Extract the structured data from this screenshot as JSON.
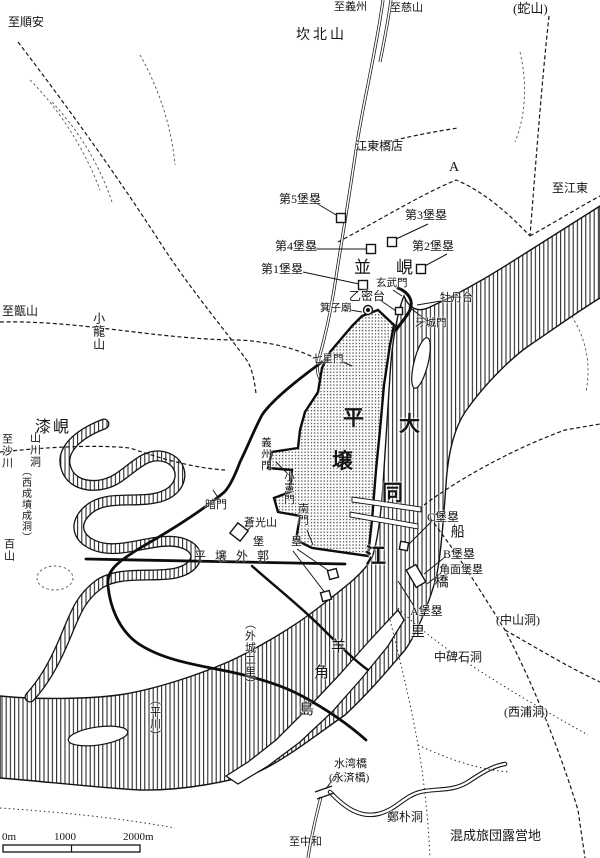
{
  "map": {
    "ink_color": "#151515",
    "paper_color": "#ffffff",
    "labels": [
      {
        "id": "to-sunan",
        "t": "至順安",
        "x": 8,
        "y": 16,
        "cls": "h",
        "fs": 12
      },
      {
        "id": "to-uiju",
        "t": "至義州",
        "x": 334,
        "y": 2,
        "cls": "h",
        "fs": 11
      },
      {
        "id": "to-jasan",
        "t": "至慈山",
        "x": 390,
        "y": 3,
        "cls": "h",
        "fs": 11
      },
      {
        "id": "sajan",
        "t": "(蛇山)",
        "x": 513,
        "y": 2,
        "cls": "h",
        "fs": 13
      },
      {
        "id": "kanbuksan",
        "t": "坎北山",
        "x": 296,
        "y": 29,
        "cls": "h",
        "fs": 14,
        "ls": 3
      },
      {
        "id": "gangdong-kyoten",
        "t": "江東橋店",
        "x": 355,
        "y": 140,
        "cls": "h",
        "fs": 12
      },
      {
        "id": "marker-a",
        "t": "A",
        "x": 449,
        "y": 161,
        "cls": "h",
        "fs": 14
      },
      {
        "id": "to-gangdong",
        "t": "至江東",
        "x": 552,
        "y": 182,
        "cls": "h",
        "fs": 12
      },
      {
        "id": "fort5",
        "t": "第5堡塁",
        "x": 279,
        "y": 193,
        "cls": "h",
        "fs": 12
      },
      {
        "id": "fort3",
        "t": "第3堡塁",
        "x": 405,
        "y": 209,
        "cls": "h",
        "fs": 12
      },
      {
        "id": "fort4",
        "t": "第4堡塁",
        "x": 275,
        "y": 240,
        "cls": "h",
        "fs": 12
      },
      {
        "id": "fort2",
        "t": "第2堡塁",
        "x": 412,
        "y": 240,
        "cls": "h",
        "fs": 12
      },
      {
        "id": "fort1",
        "t": "第1堡塁",
        "x": 261,
        "y": 263,
        "cls": "h",
        "fs": 12
      },
      {
        "id": "byeonghyeon",
        "t": "並　峴",
        "x": 354,
        "y": 259,
        "cls": "h",
        "fs": 17,
        "ls": 4
      },
      {
        "id": "hyeonmu-gate",
        "t": "玄武門",
        "x": 376,
        "y": 278,
        "cls": "h",
        "fs": 10.5
      },
      {
        "id": "eulmildae",
        "t": "乙密台",
        "x": 349,
        "y": 290,
        "cls": "h",
        "fs": 12
      },
      {
        "id": "moranbong",
        "t": "牡丹台",
        "x": 440,
        "y": 293,
        "cls": "h",
        "fs": 11
      },
      {
        "id": "gija-myo",
        "t": "箕子廟",
        "x": 320,
        "y": 303,
        "cls": "h",
        "fs": 10.5
      },
      {
        "id": "aseong-gate",
        "t": "牙城門",
        "x": 415,
        "y": 318,
        "cls": "h",
        "fs": 10.5
      },
      {
        "id": "chilseong-gate",
        "t": "七星門",
        "x": 312,
        "y": 354,
        "cls": "h",
        "fs": 10.5
      },
      {
        "id": "to-jeungsan",
        "t": "至甑山",
        "x": 2,
        "y": 305,
        "cls": "h",
        "fs": 12
      },
      {
        "id": "chilhyeon",
        "t": "漆峴",
        "x": 35,
        "y": 420,
        "cls": "h",
        "fs": 16,
        "ls": 2
      },
      {
        "id": "ammun",
        "t": "暗門",
        "x": 205,
        "y": 500,
        "cls": "h",
        "fs": 11
      },
      {
        "id": "changgwangsan",
        "t": "蒼光山",
        "x": 244,
        "y": 518,
        "cls": "h",
        "fs": 11
      },
      {
        "id": "boru",
        "t": "堡　塁",
        "x": 253,
        "y": 537,
        "cls": "h",
        "fs": 11,
        "ls": 8
      },
      {
        "id": "pyongyang-oegwak",
        "t": "平壌外郭",
        "x": 194,
        "y": 550,
        "cls": "h",
        "fs": 12,
        "ls": 9
      },
      {
        "id": "fortC",
        "t": "C堡塁",
        "x": 427,
        "y": 511,
        "cls": "h",
        "fs": 12
      },
      {
        "id": "fortB",
        "t": "B堡塁",
        "x": 443,
        "y": 548,
        "cls": "h",
        "fs": 12
      },
      {
        "id": "kakumen-boru",
        "t": "角面堡塁",
        "x": 439,
        "y": 565,
        "cls": "h",
        "fs": 11
      },
      {
        "id": "fortA",
        "t": "A堡塁",
        "x": 410,
        "y": 605,
        "cls": "h",
        "fs": 12
      },
      {
        "id": "jungsan-dong",
        "t": "(中山洞)",
        "x": 496,
        "y": 614,
        "cls": "h",
        "fs": 12
      },
      {
        "id": "jungbiseok-dong",
        "t": "中碑石洞",
        "x": 434,
        "y": 651,
        "cls": "h",
        "fs": 12
      },
      {
        "id": "seopo-dong",
        "t": "(西浦洞)",
        "x": 504,
        "y": 706,
        "cls": "h",
        "fs": 12
      },
      {
        "id": "suman-bridge",
        "t": "水湾橋",
        "x": 334,
        "y": 759,
        "cls": "h",
        "fs": 11
      },
      {
        "id": "yeongje-bridge",
        "t": "(永済橋)",
        "x": 329,
        "y": 773,
        "cls": "h",
        "fs": 11
      },
      {
        "id": "jeongpark-dong",
        "t": "鄭朴洞",
        "x": 387,
        "y": 811,
        "cls": "h",
        "fs": 12
      },
      {
        "id": "to-junghwa",
        "t": "至中和",
        "x": 289,
        "y": 837,
        "cls": "h",
        "fs": 11
      },
      {
        "id": "honsei-camp",
        "t": "混成旅団露営地",
        "x": 450,
        "y": 829,
        "cls": "h",
        "fs": 13
      },
      {
        "id": "scale-0",
        "t": "0m",
        "x": 2,
        "y": 832,
        "cls": "h",
        "fs": 11
      },
      {
        "id": "scale-1000",
        "t": "1000",
        "x": 54,
        "y": 832,
        "cls": "h",
        "fs": 11
      },
      {
        "id": "scale-2000",
        "t": "2000m",
        "x": 123,
        "y": 832,
        "cls": "h",
        "fs": 11
      },
      {
        "id": "soryongsan",
        "t": "小龍山",
        "x": 92,
        "y": 312,
        "cls": "v",
        "fs": 12
      },
      {
        "id": "to-sacheon",
        "t": "至沙川",
        "x": 0,
        "y": 433,
        "cls": "v",
        "fs": 11
      },
      {
        "id": "sancheon-dong",
        "t": "山川洞",
        "x": 28,
        "y": 432,
        "cls": "v",
        "fs": 11
      },
      {
        "id": "seoseong-dong",
        "t": "（西成墳成洞）",
        "x": 19,
        "y": 466,
        "cls": "v",
        "fs": 10
      },
      {
        "id": "baeksan",
        "t": "百山",
        "x": 2,
        "y": 538,
        "cls": "v",
        "fs": 11
      },
      {
        "id": "uiju-gate",
        "t": "義州門",
        "x": 260,
        "y": 437,
        "cls": "v",
        "fs": 10.5
      },
      {
        "id": "soheon-gate",
        "t": "小憲門",
        "x": 283,
        "y": 471,
        "cls": "v",
        "fs": 10.5
      },
      {
        "id": "nam-gate",
        "t": "南門",
        "x": 297,
        "y": 503,
        "cls": "v",
        "fs": 10.5
      },
      {
        "id": "oeseong-2ri",
        "t": "（外城二里）",
        "x": 243,
        "y": 618,
        "cls": "v",
        "fs": 11
      },
      {
        "id": "pyeongcheon",
        "t": "（平川）",
        "x": 148,
        "y": 694,
        "cls": "v",
        "fs": 11
      },
      {
        "id": "seongyori-seon",
        "t": "船",
        "x": 448,
        "y": 524,
        "cls": "v",
        "fs": 14
      },
      {
        "id": "seongyori-gyo",
        "t": "橋",
        "x": 432,
        "y": 574,
        "cls": "v",
        "fs": 14
      },
      {
        "id": "seongyori-ri",
        "t": "里",
        "x": 408,
        "y": 624,
        "cls": "v",
        "fs": 14
      },
      {
        "id": "pyongyang-pyeong",
        "t": "平",
        "x": 343,
        "y": 407,
        "cls": "big"
      },
      {
        "id": "pyongyang-yang",
        "t": "壌",
        "x": 332,
        "y": 450,
        "cls": "big"
      },
      {
        "id": "taedong-dae",
        "t": "大",
        "x": 399,
        "y": 413,
        "cls": "big"
      },
      {
        "id": "taedong-dong",
        "t": "同",
        "x": 382,
        "y": 482,
        "cls": "big"
      },
      {
        "id": "taedong-gang",
        "t": "江",
        "x": 365,
        "y": 545,
        "cls": "big"
      },
      {
        "id": "yanggak-yang",
        "t": "羊",
        "x": 331,
        "y": 640,
        "cls": "h",
        "fs": 15
      },
      {
        "id": "yanggak-gak",
        "t": "角",
        "x": 314,
        "y": 666,
        "cls": "h",
        "fs": 15
      },
      {
        "id": "yanggak-do",
        "t": "島",
        "x": 299,
        "y": 703,
        "cls": "h",
        "fs": 15
      }
    ],
    "markers": [
      {
        "id": "fort5-square",
        "shape": "square",
        "x": 341,
        "y": 218,
        "s": 9
      },
      {
        "id": "fort4-square",
        "shape": "square",
        "x": 371,
        "y": 249,
        "s": 9
      },
      {
        "id": "fort3-square",
        "shape": "square",
        "x": 392,
        "y": 242,
        "s": 9
      },
      {
        "id": "fort2-square",
        "shape": "square",
        "x": 421,
        "y": 269,
        "s": 9
      },
      {
        "id": "fort1-square",
        "shape": "square",
        "x": 363,
        "y": 285,
        "s": 9
      },
      {
        "id": "eulmildae-square",
        "shape": "square",
        "x": 399,
        "y": 311,
        "s": 7
      },
      {
        "id": "gija-circle",
        "shape": "circle",
        "x": 368,
        "y": 310,
        "r": 4.5
      },
      {
        "id": "gija-dot",
        "shape": "circle",
        "x": 368,
        "y": 310,
        "r": 1.4,
        "fill": "#141414"
      },
      {
        "id": "changgwang-diamond",
        "shape": "square",
        "x": 239,
        "y": 532,
        "s": 13,
        "rot": 38
      },
      {
        "id": "outer-fort-square-1",
        "shape": "square",
        "x": 333,
        "y": 574,
        "s": 9,
        "rot": -15
      },
      {
        "id": "outer-fort-square-2",
        "shape": "square",
        "x": 326,
        "y": 596,
        "s": 9,
        "rot": -15
      },
      {
        "id": "fortC-square",
        "shape": "square",
        "x": 404,
        "y": 546,
        "s": 8,
        "rot": 10
      },
      {
        "id": "kakumen-rect",
        "shape": "rect",
        "x": 416,
        "y": 576,
        "w": 11,
        "h": 20,
        "rot": -30
      }
    ],
    "scalebar": {
      "ticks": [
        "0m",
        "1000",
        "2000m"
      ]
    }
  }
}
